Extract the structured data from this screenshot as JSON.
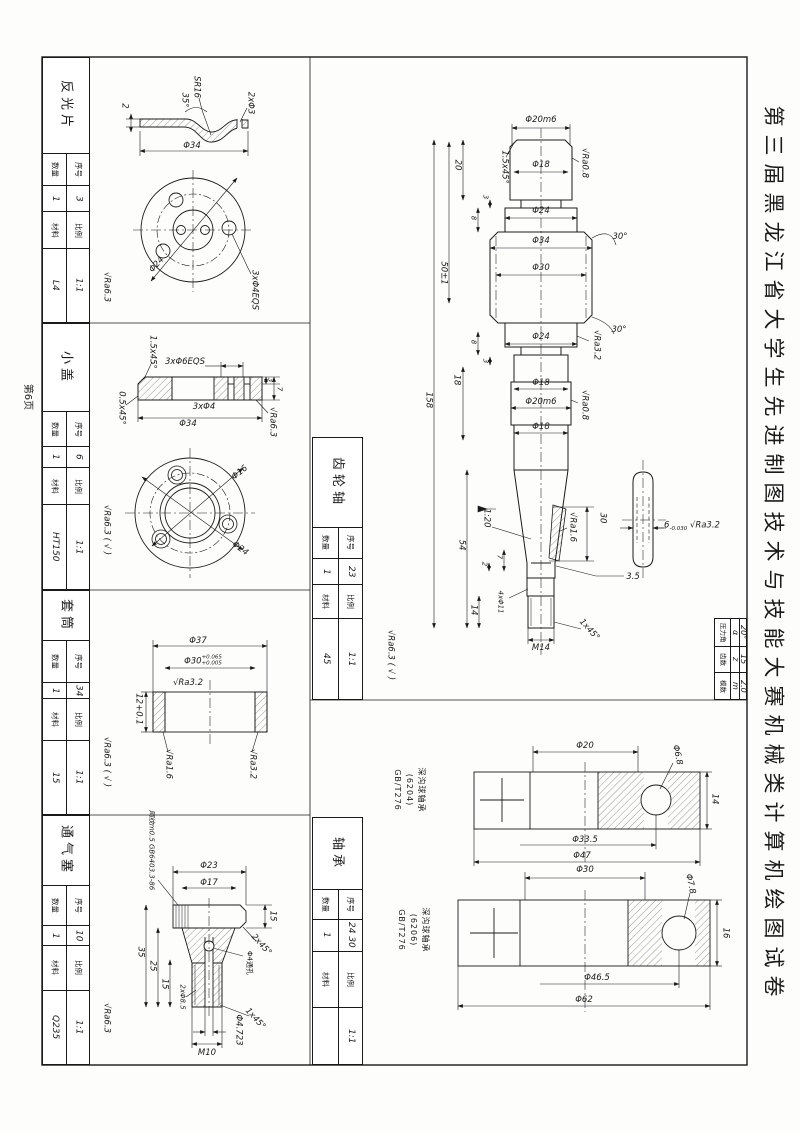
{
  "sheet": {
    "page_note": "第6页",
    "title": "第三届黑龙江省大学生先进制图技术与技能大赛机械类计算机绘图试卷",
    "labels": {
      "xuhao": "序号",
      "shuliang": "数量",
      "bili": "比例",
      "cailiao": "材料"
    }
  },
  "parts": {
    "reflector": {
      "name": "反光片",
      "xuhao": "3",
      "shuliang": "1",
      "bili": "1:1",
      "cailiao": "L4",
      "finish": "√Ra6.3",
      "dims": {
        "sr": "SR16",
        "ang": "35°",
        "t": "2",
        "holes2": "2xΦ3",
        "od": "Φ34",
        "bcd": "Φ24",
        "holes3": "3xΦ4EQS"
      }
    },
    "cover": {
      "name": "小盖",
      "xuhao": "6",
      "shuliang": "1",
      "bili": "1:1",
      "cailiao": "HT150",
      "finish": "√Ra6.3",
      "finish_other": "( √ )",
      "dims": {
        "cham1": "1.5x45°",
        "holes6": "3xΦ6EQS",
        "holes4": "3xΦ4",
        "od": "Φ34",
        "cham2": "0.5x45°",
        "d3": "3",
        "d7": "7",
        "ra": "√Ra6.3",
        "bore": "Φ16",
        "bcd": "Φ24"
      }
    },
    "sleeve": {
      "name": "套筒",
      "xuhao": "34",
      "shuliang": "1",
      "bili": "1:1",
      "cailiao": "15",
      "finish": "√Ra6.3",
      "finish_other": "( √ )",
      "dims": {
        "od": "Φ37",
        "bore": "Φ30",
        "bore_tol_u": "+0.065",
        "bore_tol_l": "+0.005",
        "ra_top": "√Ra3.2",
        "len": "12+0.1",
        "ra_l": "√Ra1.6",
        "ra_r": "√Ra3.2"
      }
    },
    "vent_plug": {
      "name": "通气塞",
      "xuhao": "10",
      "shuliang": "1",
      "bili": "1:1",
      "cailiao": "Q235",
      "finish": "√Ra6.3",
      "dims": {
        "head_od": "Φ23",
        "head_id": "Φ17",
        "knurl": "网纹m0.5 GB6403.3-86",
        "h15": "15",
        "cham2": "2x45°",
        "h35": "35",
        "h25": "25",
        "h15b": "15",
        "holes": "2xΦ8.5",
        "hole4": "Φ4通孔",
        "cham1": "1x45°",
        "bottom": "Φ4.723",
        "thread": "M10"
      }
    },
    "gear_shaft": {
      "name": "齿轮轴",
      "xuhao": "23",
      "shuliang": "1",
      "bili": "1:1",
      "cailiao": "45",
      "finish": "√Ra6.3",
      "finish_other": "( √ )",
      "gear_table": {
        "rows": [
          {
            "label": "压力角",
            "sym": "α",
            "val": "20°"
          },
          {
            "label": "齿数",
            "sym": "z",
            "val": "15"
          },
          {
            "label": "模数",
            "sym": "m",
            "val": "2.0"
          }
        ]
      },
      "dims": {
        "d20m6a": "Φ20m6",
        "cham": "1.5x45°",
        "d18a": "Φ18",
        "ra08a": "√Ra0.8",
        "L20": "20",
        "L3a": "3",
        "L8a": "8",
        "d24a": "Φ24",
        "d34": "Φ34",
        "ang30a": "30°",
        "d30": "Φ30",
        "L50": "50±1",
        "ang30b": "30°",
        "d24b": "Φ24",
        "ra32a": "√Ra3.2",
        "L8b": "8",
        "L3b": "3",
        "L18": "18",
        "d18b": "Φ18",
        "d20m6b": "Φ20m6",
        "ra08b": "√Ra0.8",
        "d18c": "Φ18",
        "L158": "158",
        "taper": "1:20",
        "L54": "54",
        "ra16": "√Ra1.6",
        "L30": "30",
        "L35": "3.5",
        "L2": "2",
        "L7": "7",
        "L14": "14",
        "holes": "4xΦ11",
        "thread": "M14",
        "cham2": "1x45°",
        "key_w": "6",
        "key_tol": "-0.030",
        "key_ra": "√Ra3.2"
      }
    },
    "bearing": {
      "name": "轴承",
      "xuhao": "24 30",
      "shuliang": "1",
      "bili": "1:1",
      "cailiao": "",
      "b1": {
        "type": "深沟球轴承",
        "spec": "(6204)",
        "std": "GB/T276",
        "bore": "Φ20",
        "ball": "Φ6.8",
        "pitch": "Φ33.5",
        "od": "Φ47",
        "width": "14"
      },
      "b2": {
        "type": "深沟球轴承",
        "spec": "(6206)",
        "std": "GB/T276",
        "bore": "Φ30",
        "ball": "Φ7.8",
        "pitch": "Φ46.5",
        "od": "Φ62",
        "width": "16"
      }
    }
  }
}
